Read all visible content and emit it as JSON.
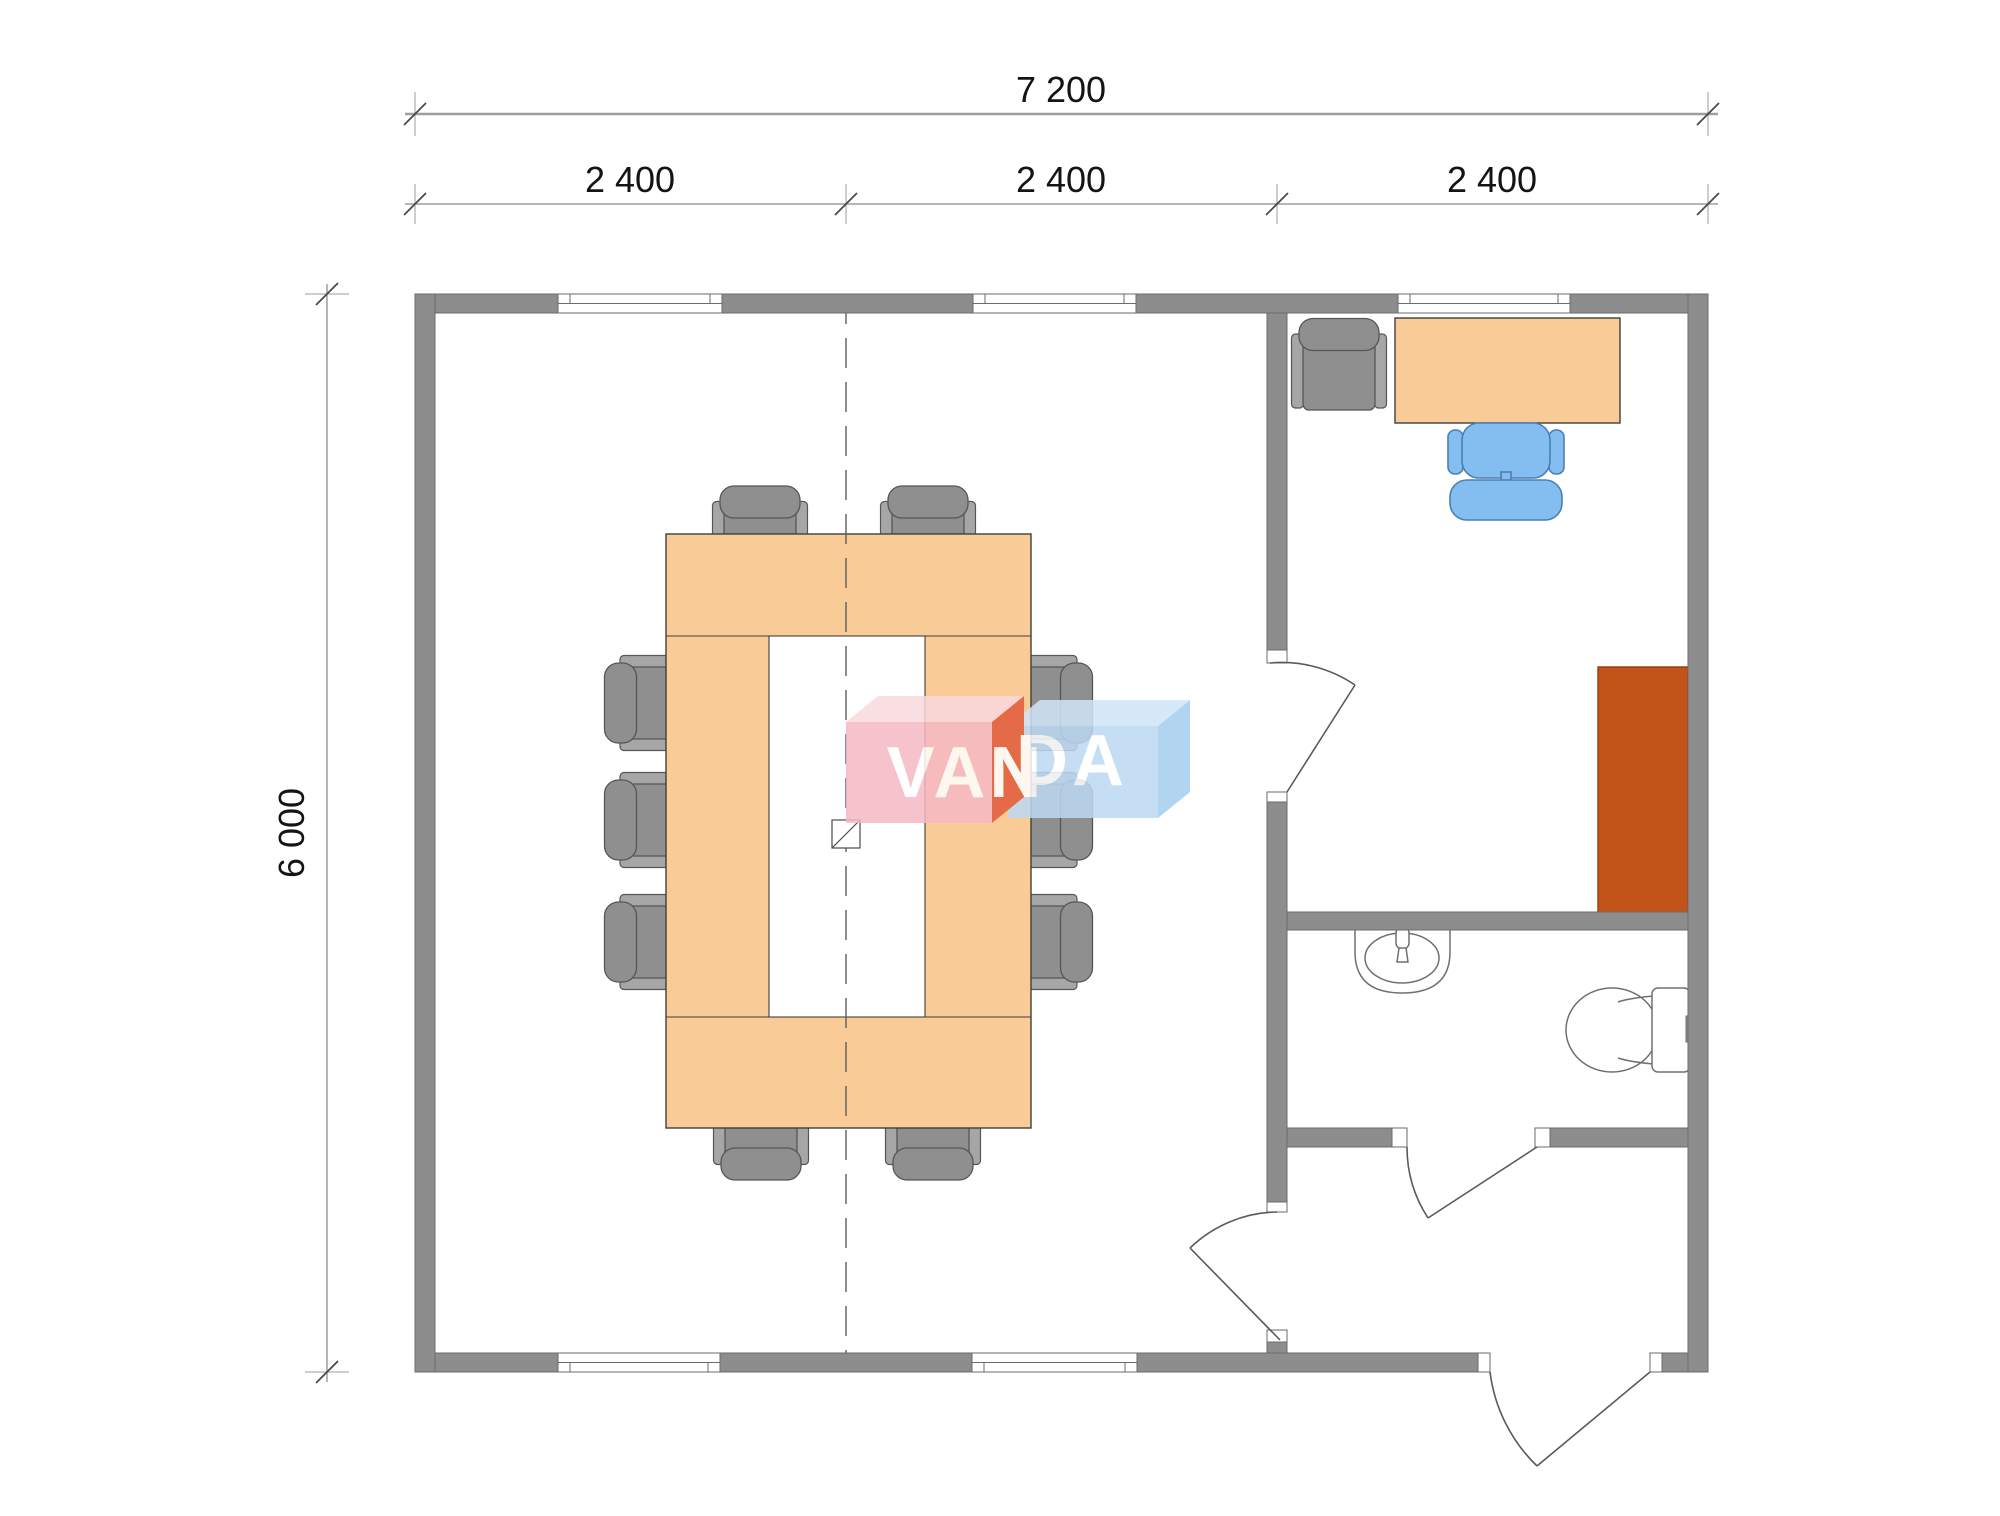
{
  "dimensions": {
    "overall_width_mm": "7 200",
    "module_1_mm": "2 400",
    "module_2_mm": "2 400",
    "module_3_mm": "2 400",
    "overall_depth_mm": "6 000"
  },
  "watermark": {
    "part_red": "VAN",
    "part_blue": "DA"
  },
  "contents": {
    "conference_chairs": 10,
    "windows": 5,
    "doors": 4,
    "furniture": [
      "conference-table",
      "office-desk",
      "office-corner-chair",
      "desk-chair",
      "cabinet",
      "sink",
      "toilet"
    ]
  },
  "colors": {
    "wall": "#8D8D8D",
    "wall_stroke": "#6B6B6B",
    "furniture_wood": "#F9CB96",
    "furniture_wood_stroke": "#3F3F3F",
    "chair_gray": "#8F8F8F",
    "chair_gray_light": "#A6A6A6",
    "chair_stroke": "#565656",
    "chair_blue": "#84BEF0",
    "chair_blue_stroke": "#4A7FB5",
    "cabinet": "#C2541A",
    "cabinet_stroke": "#8F3D0E",
    "fixture_stroke": "#707070",
    "dim_line": "#9E9E9E",
    "dim_text": "#141414",
    "tick": "#4A4A4A",
    "centerline": "#5E5E5E",
    "logo_pink": "#F5B9C4",
    "logo_pink_top": "#F9D9DE",
    "logo_red": "#E25A3A",
    "logo_blue": "#BCD9F3",
    "logo_blue_top": "#CFE6F8",
    "logo_blue_side": "#A4CEEF",
    "logo_text": "#FFFFFF"
  }
}
